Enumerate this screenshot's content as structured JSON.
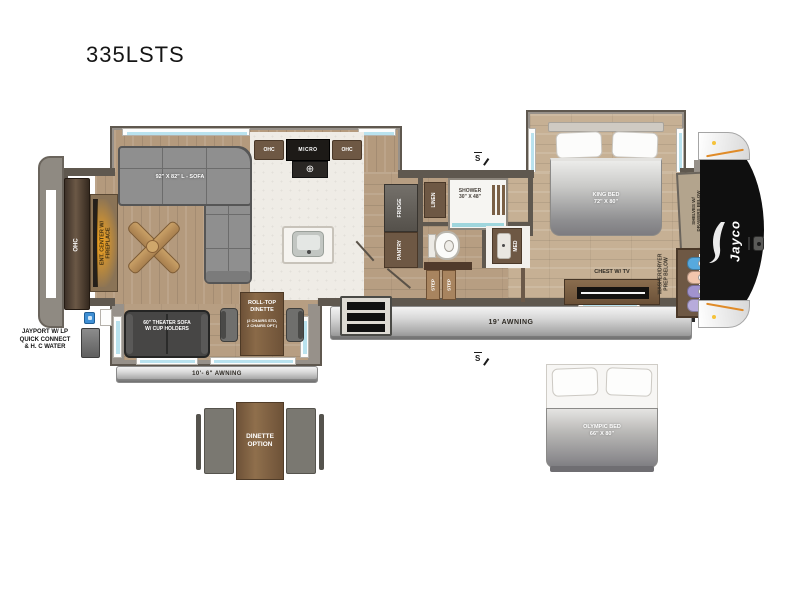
{
  "title": "335LSTS",
  "labels": {
    "rear_ohc": "OHC",
    "ent_center": "ENT. CENTER W/\nFIREPLACE",
    "sofa": "92\" X 82\" L - SOFA",
    "ohc_left": "OHC",
    "micro": "MICRO",
    "ohc_right": "OHC",
    "fridge": "FRIDGE",
    "pantry": "PANTRY",
    "linen": "LINEN",
    "shower": "SHOWER\n30\" X 48\"",
    "med": "MED",
    "step_1": "STEP",
    "step_2": "STEP",
    "king_bed": "KING BED\n72\" X 80\"",
    "chest_tv": "CHEST W/ TV",
    "washer_dryer": "WASHER/DRYER\nPREP BELOW",
    "shelves": "SHELVES W/\nDRAWERS BELOW",
    "brand": "Jayco",
    "awning_19": "19' AWNING",
    "awning_10": "10'- 6\" AWNING",
    "theater_sofa": "60\" THEATER SOFA\nW/ CUP HOLDERS",
    "rolltop_dinette": "ROLL-TOP\nDINETTE",
    "rolltop_note": "(2 CHAIRS STD,\n2 CHAIRS OPT.)",
    "jayport": "JAYPORT W/ LP\nQUICK CONNECT\n& H. C WATER",
    "dinette_option": "DINETTE\nOPTION",
    "olympic_bed": "OLYMPIC BED\n66\" X 80\"",
    "solar_mark_top": "S",
    "solar_mark_bottom": "S"
  },
  "colors": {
    "wall": "#5f584f",
    "wood_floor": "#b79e82",
    "wood_floor_light": "#c6b094",
    "kitchen_tile": "#efece6",
    "slide_wall": "#97918a",
    "window_glass": "#b9e2ee",
    "cabinet_brown": "#6e5844",
    "sofa_gray": "#8f8f8f",
    "theater_sofa_dark": "#474645",
    "fireplace_glow": "#faa61a",
    "shower_glass_teal": "#9fd6dd",
    "front_cap_black": "#0f0f0f",
    "awning_silver": "#c9c9c9",
    "hanger_blue": "#57a9de",
    "hanger_peach": "#f2c6ad",
    "hanger_purple": "#a193ce",
    "hanger_lavender": "#b7abdb",
    "jayport_blue": "#3f8fd4",
    "cap_accent_orange": "#e08b28"
  }
}
